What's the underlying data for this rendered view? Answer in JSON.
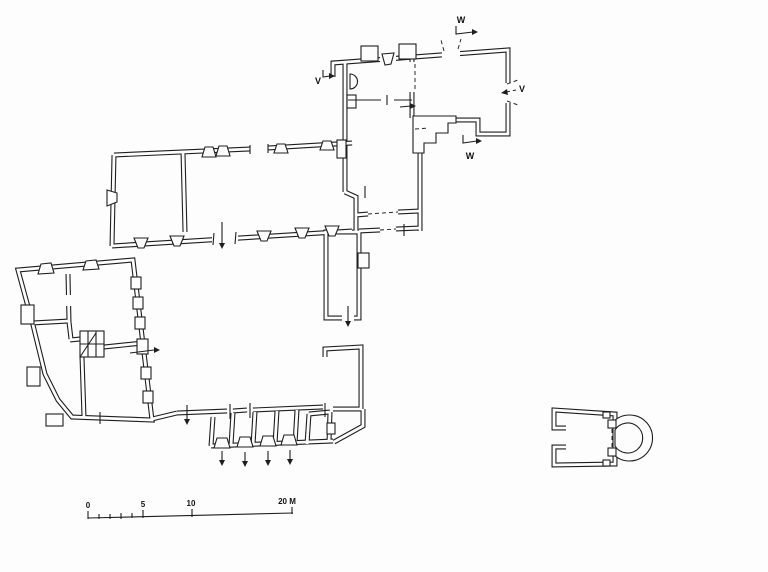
{
  "sheet": {
    "background": "#fdfdfd",
    "ink": "#1e1e1e"
  },
  "section_markers": {
    "w_top": "W",
    "v_left": "V",
    "v_right": "V",
    "w_bottom": "W"
  },
  "scale_bar": {
    "tick_labels": [
      "0",
      "5",
      "10",
      "20 M"
    ]
  }
}
